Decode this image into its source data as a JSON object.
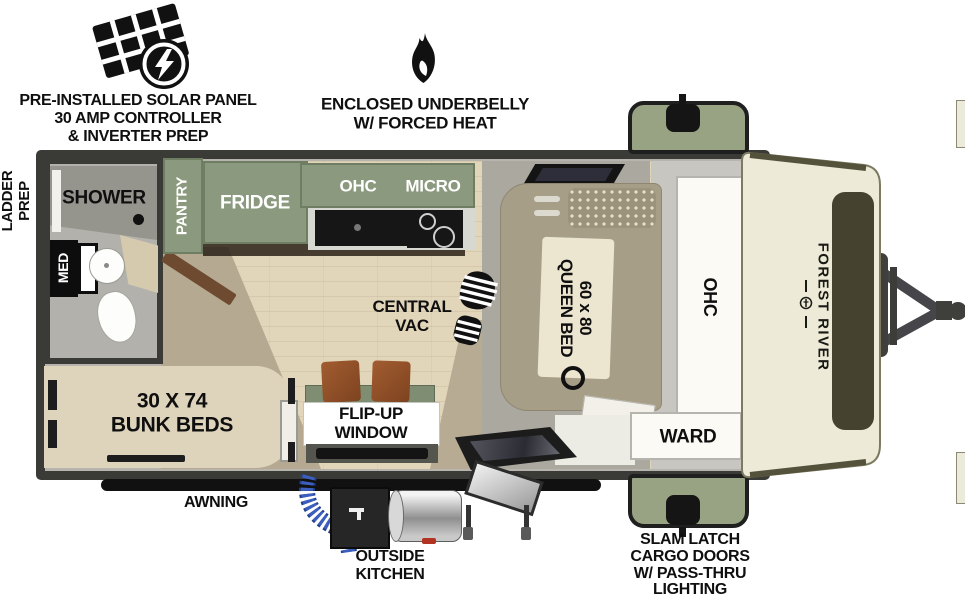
{
  "callouts": {
    "solar": [
      "PRE-INSTALLED SOLAR PANEL",
      "30 AMP CONTROLLER",
      "& INVERTER PREP"
    ],
    "underbelly": [
      "ENCLOSED UNDERBELLY",
      "W/ FORCED HEAT"
    ],
    "ladder": [
      "LADDER",
      "PREP"
    ],
    "awning": "AWNING",
    "outside_kitchen": [
      "OUTSIDE",
      "KITCHEN"
    ],
    "cargo": [
      "SLAM LATCH",
      "CARGO DOORS",
      "W/ PASS-THRU",
      "LIGHTING"
    ]
  },
  "rooms": {
    "shower": "SHOWER",
    "med": "MED",
    "pantry": "PANTRY",
    "fridge": "FRIDGE",
    "ohc_kitchen": "OHC",
    "micro": "MICRO",
    "central_vac": [
      "CENTRAL",
      "VAC"
    ],
    "queen_bed": [
      "60 x 80",
      "QUEEN BED"
    ],
    "ohc_front": "OHC",
    "ward": "WARD",
    "bunk_beds": [
      "30 X 74",
      "BUNK BEDS"
    ],
    "flip_up_window": [
      "FLIP-UP",
      "WINDOW"
    ]
  },
  "brand": "FOREST RIVER",
  "icons": {
    "solar_panel": "solar-panel-icon",
    "lightning_bolt": "bolt-icon",
    "flame": "flame-icon",
    "boot_print": "boot-print-icon",
    "cargo_latch": "latch-icon",
    "hitch": "hitch-icon"
  },
  "colors": {
    "wall_dark": "#3a3a37",
    "cabinet_green": "#8b9a7e",
    "cargo_green": "#98a384",
    "bed_khaki": "#a79e87",
    "bunk_cream": "#ded4bb",
    "floor_wood": "#e2d6ba",
    "rug_tan": "#b3a78f",
    "cap_cream": "#edead8",
    "hose_blue": "#3c5fbe",
    "label_black": "#0f0f0f"
  }
}
